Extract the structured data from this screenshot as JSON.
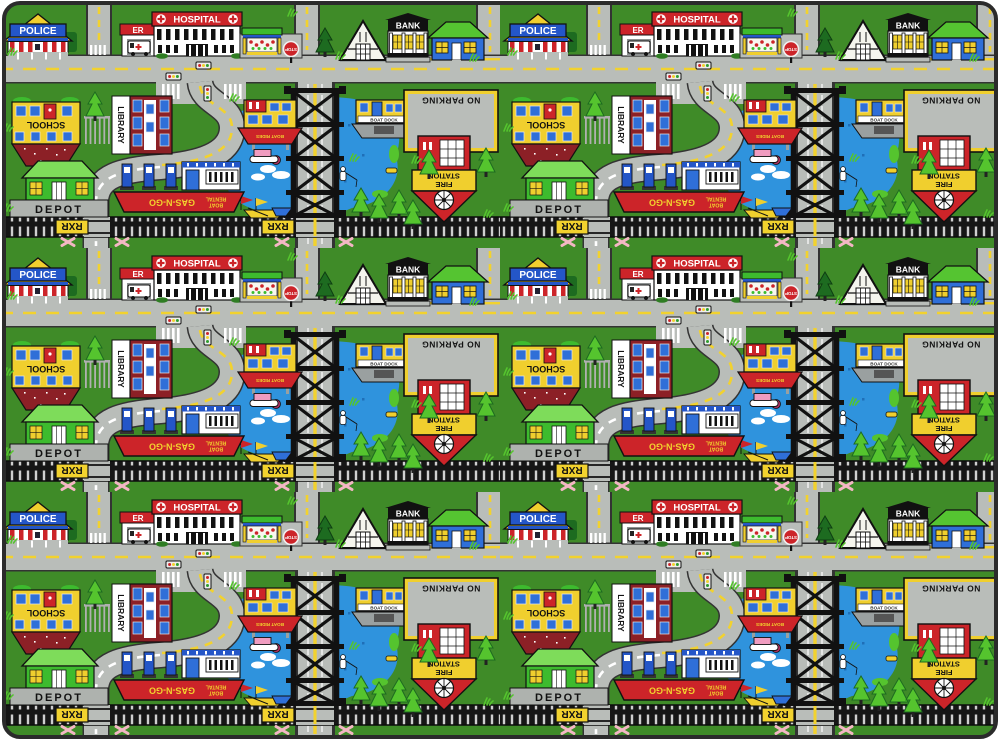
{
  "playmat": {
    "buildings": {
      "police": {
        "label": "POLICE"
      },
      "hospital": {
        "label": "HOSPITAL",
        "er_label": "ER"
      },
      "bank": {
        "label": "BANK"
      },
      "school": {
        "label": "SCHOOL"
      },
      "library": {
        "label": "LIBRARY"
      },
      "depot": {
        "label": "DEPOT"
      },
      "fire_station": {
        "label_line1": "FIRE",
        "label_line2": "STATION"
      },
      "gas_station": {
        "label": "GAS-N-GO",
        "sub_line1": "BOAT",
        "sub_line2": "RENTAL"
      },
      "lake_pavilion": {
        "label": "BOAT RIDES"
      },
      "boat_dock": {
        "label": "BOAT DOCK"
      }
    },
    "signs": {
      "stop": "STOP",
      "no_parking": "NO PARKING",
      "railroad_crossing": "RXR"
    },
    "colors": {
      "grass": "#3f8b28",
      "road": "#b9bdb9",
      "lake": "#2f93dd",
      "red": "#cc2429",
      "yellow": "#f2df3a",
      "roof_gold": "#f0cf2e",
      "blue": "#2456c8",
      "bright_green": "#55c42e",
      "dark_green": "#1d6b20",
      "brick": "#8c2026",
      "rail_black": "#161616",
      "pink_x": "#f3b7c4",
      "platform_gray": "#aeb2ae"
    },
    "pattern": {
      "columns": 2,
      "rows": 3
    }
  }
}
